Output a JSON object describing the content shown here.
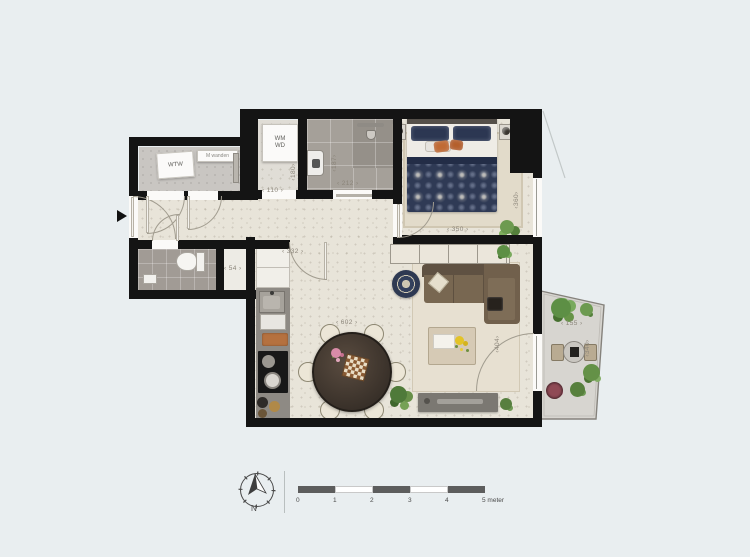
{
  "rooms": {
    "storage": {
      "unit_label": "WTW",
      "plate_label": "M wanden"
    },
    "laundry": {
      "line1": "WM",
      "line2": "WD"
    }
  },
  "dims": {
    "laundry_width": "110",
    "laundry_depth": "180",
    "bath_width": "212",
    "bath_depth": "187",
    "bedroom_width": "350",
    "bedroom_depth": "360",
    "living_entry": "332",
    "living_width": "602",
    "living_depth": "404",
    "closet_width": "54",
    "balcony_width": "155",
    "balcony_depth": "340"
  },
  "footer": {
    "north_label": "N",
    "scale_ticks": [
      "0",
      "1",
      "2",
      "3",
      "4"
    ],
    "scale_end_label": "5 meter"
  },
  "colors": {
    "wall": "#141414",
    "floor_cream": "#e8e4d9",
    "accent_navy": "#2f3a55",
    "accent_orange": "#c06a34",
    "sofa_brown": "#786751",
    "plant_green": "#5f8b4a"
  }
}
